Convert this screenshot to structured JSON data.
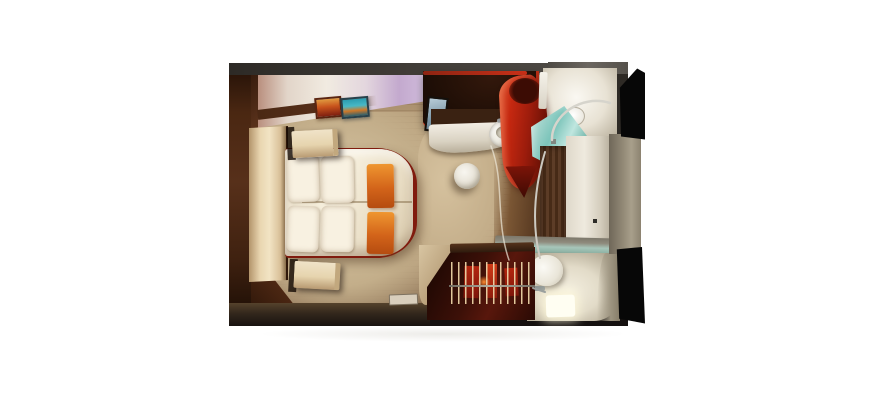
{
  "meta": {
    "description": "3D top-down cutaway render of a cruise ship stateroom floor plan on a white background",
    "background": "#ffffff"
  },
  "labels": {
    "room": "cruise ship stateroom, top-down cutaway render",
    "floor": "wood plank floor",
    "carpet": "beige carpet area",
    "bed": "queen bed with white duvet and orange runner",
    "pillows": "four white pillows",
    "headboard": "cream headboard panel",
    "nightstandTop": "nightstand (port side)",
    "nightstandBottom": "nightstand (starboard side)",
    "artworkRed": "framed abstract artwork, red-orange",
    "artworkBlue": "framed abstract artwork, blue with orange band",
    "cabinet": "dark overhead cabinet with red trim",
    "tv": "wall-mounted TV screen",
    "desk": "curved white vanity desk",
    "sink": "washbasin with chrome faucet",
    "stool": "round white stool",
    "shower": "curved red shower enclosure wall",
    "showerGlass": "aqua glass shower door",
    "showerhead": "round shower head with chrome arm",
    "bathFloor": "bright shower-room floor",
    "corridorWood": "entry corridor wood wall",
    "corridorWhite": "entry corridor white wall",
    "transom": "frosted glass transom over water closet",
    "toiletRoom": "water closet with glowing floor tile",
    "toilet": "white toilet cylinder",
    "closet": "open wardrobe with hangers and red garments",
    "hangers": "row of hangers on chrome rod",
    "vent": "floor-level vent plate",
    "wedgeWall": "black cutaway exterior wall segment"
  },
  "colors": {
    "bg": "#ffffff",
    "frame": "#2e2a25",
    "floor-light": "#c9b492",
    "floor-mid": "#b49a76",
    "floor-dark": "#6f523a",
    "carpet": "#d9c8a6",
    "wall-brown": "#57301a",
    "wall-brown-dark": "#241107",
    "wall-face": "#f1ebe1",
    "wall-lavender": "#c3a9ce",
    "cornice": "#4a2814",
    "headboard": "#f2e4c4",
    "mattress": "#f6efdd",
    "pillow": "#f8f1e1",
    "runner-orange": "#d3641a",
    "runner-orange-light": "#ef9630",
    "bed-frame-red": "#801b0e",
    "nightstand": "#e6d4ae",
    "art-red": "#c8531c",
    "art-blue": "#2b9cb0",
    "cabinet-dark": "#1c0d05",
    "trim-red": "#c93018",
    "tv-screen": "#7d98a8",
    "desk-white": "#f2ede3",
    "stool": "#e4dfd2",
    "shower-red": "#c52810",
    "shower-red-deep": "#490c04",
    "glass-aqua": "#7cc4ba",
    "glass-aqua-light": "#bfe6df",
    "bath-white": "#e8e2d4",
    "bath-shadow": "#948b78",
    "chrome": "#d6d4cc",
    "wood-wall": "#5d3d27",
    "corridor-white": "#efeade",
    "transom-green": "#a7c6ba",
    "toilet-cream": "#e2dbc8",
    "glow-white": "#fffef2",
    "closet-dark": "#3c1008",
    "closet-red": "#b3260f",
    "rod-gray": "#b5b0a2",
    "gray-wall": "#938a77",
    "wedge-black": "#070707",
    "bottom-wall": "#33271c"
  }
}
